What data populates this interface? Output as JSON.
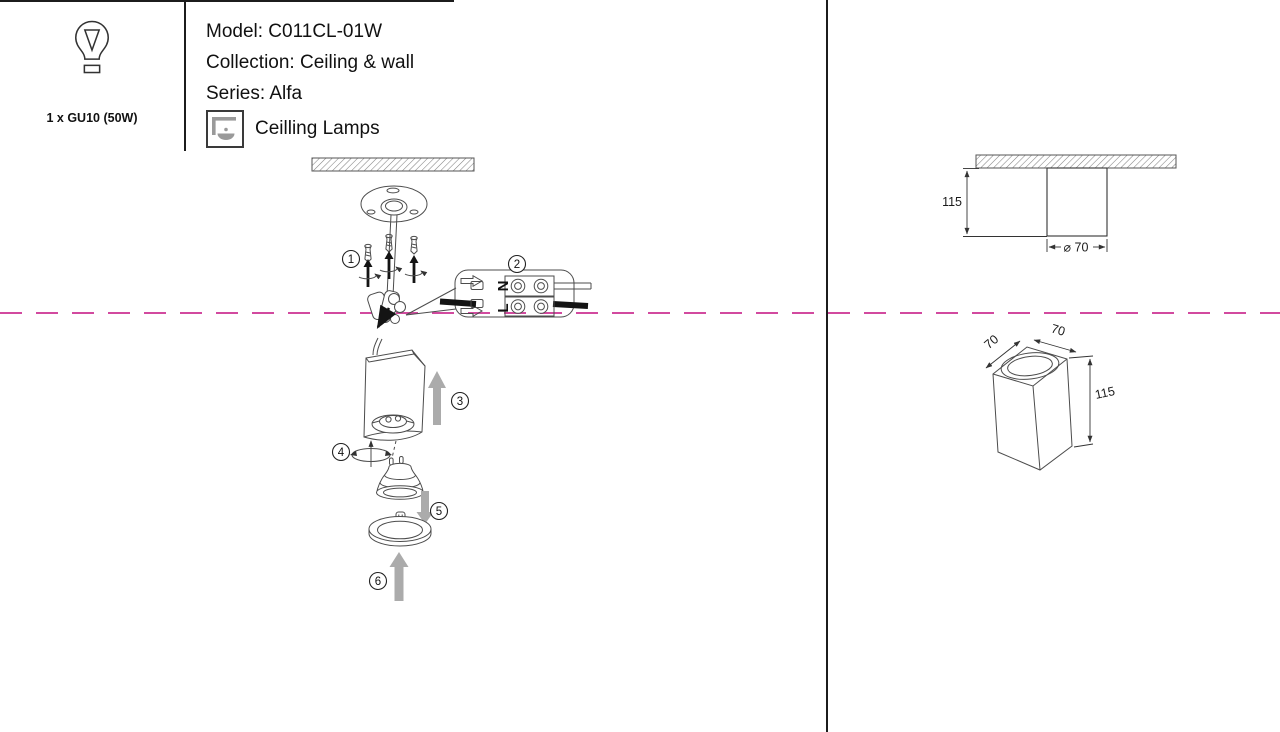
{
  "install_diagram": {
    "steps": [
      "1",
      "2",
      "3",
      "4",
      "5",
      "6"
    ],
    "terminal": {
      "neutral": "N",
      "line": "L"
    }
  },
  "dimension_views": {
    "side": {
      "height": "115",
      "diameter": "⌀ 70"
    },
    "iso": {
      "depth": "70",
      "width": "70",
      "height": "115"
    }
  },
  "spec": {
    "bulb_caption": "1 x GU10 (50W)",
    "model": "Model: C011CL-01W",
    "collection": "Collection: Ceiling & wall",
    "series": "Series: Alfa",
    "category": "Ceilling Lamps"
  },
  "colors": {
    "cut_line": "#d24a9f",
    "arrow_gray": "#ababab",
    "sketch_line": "#4c4c4c",
    "icon_gray": "#9a9a9a"
  }
}
